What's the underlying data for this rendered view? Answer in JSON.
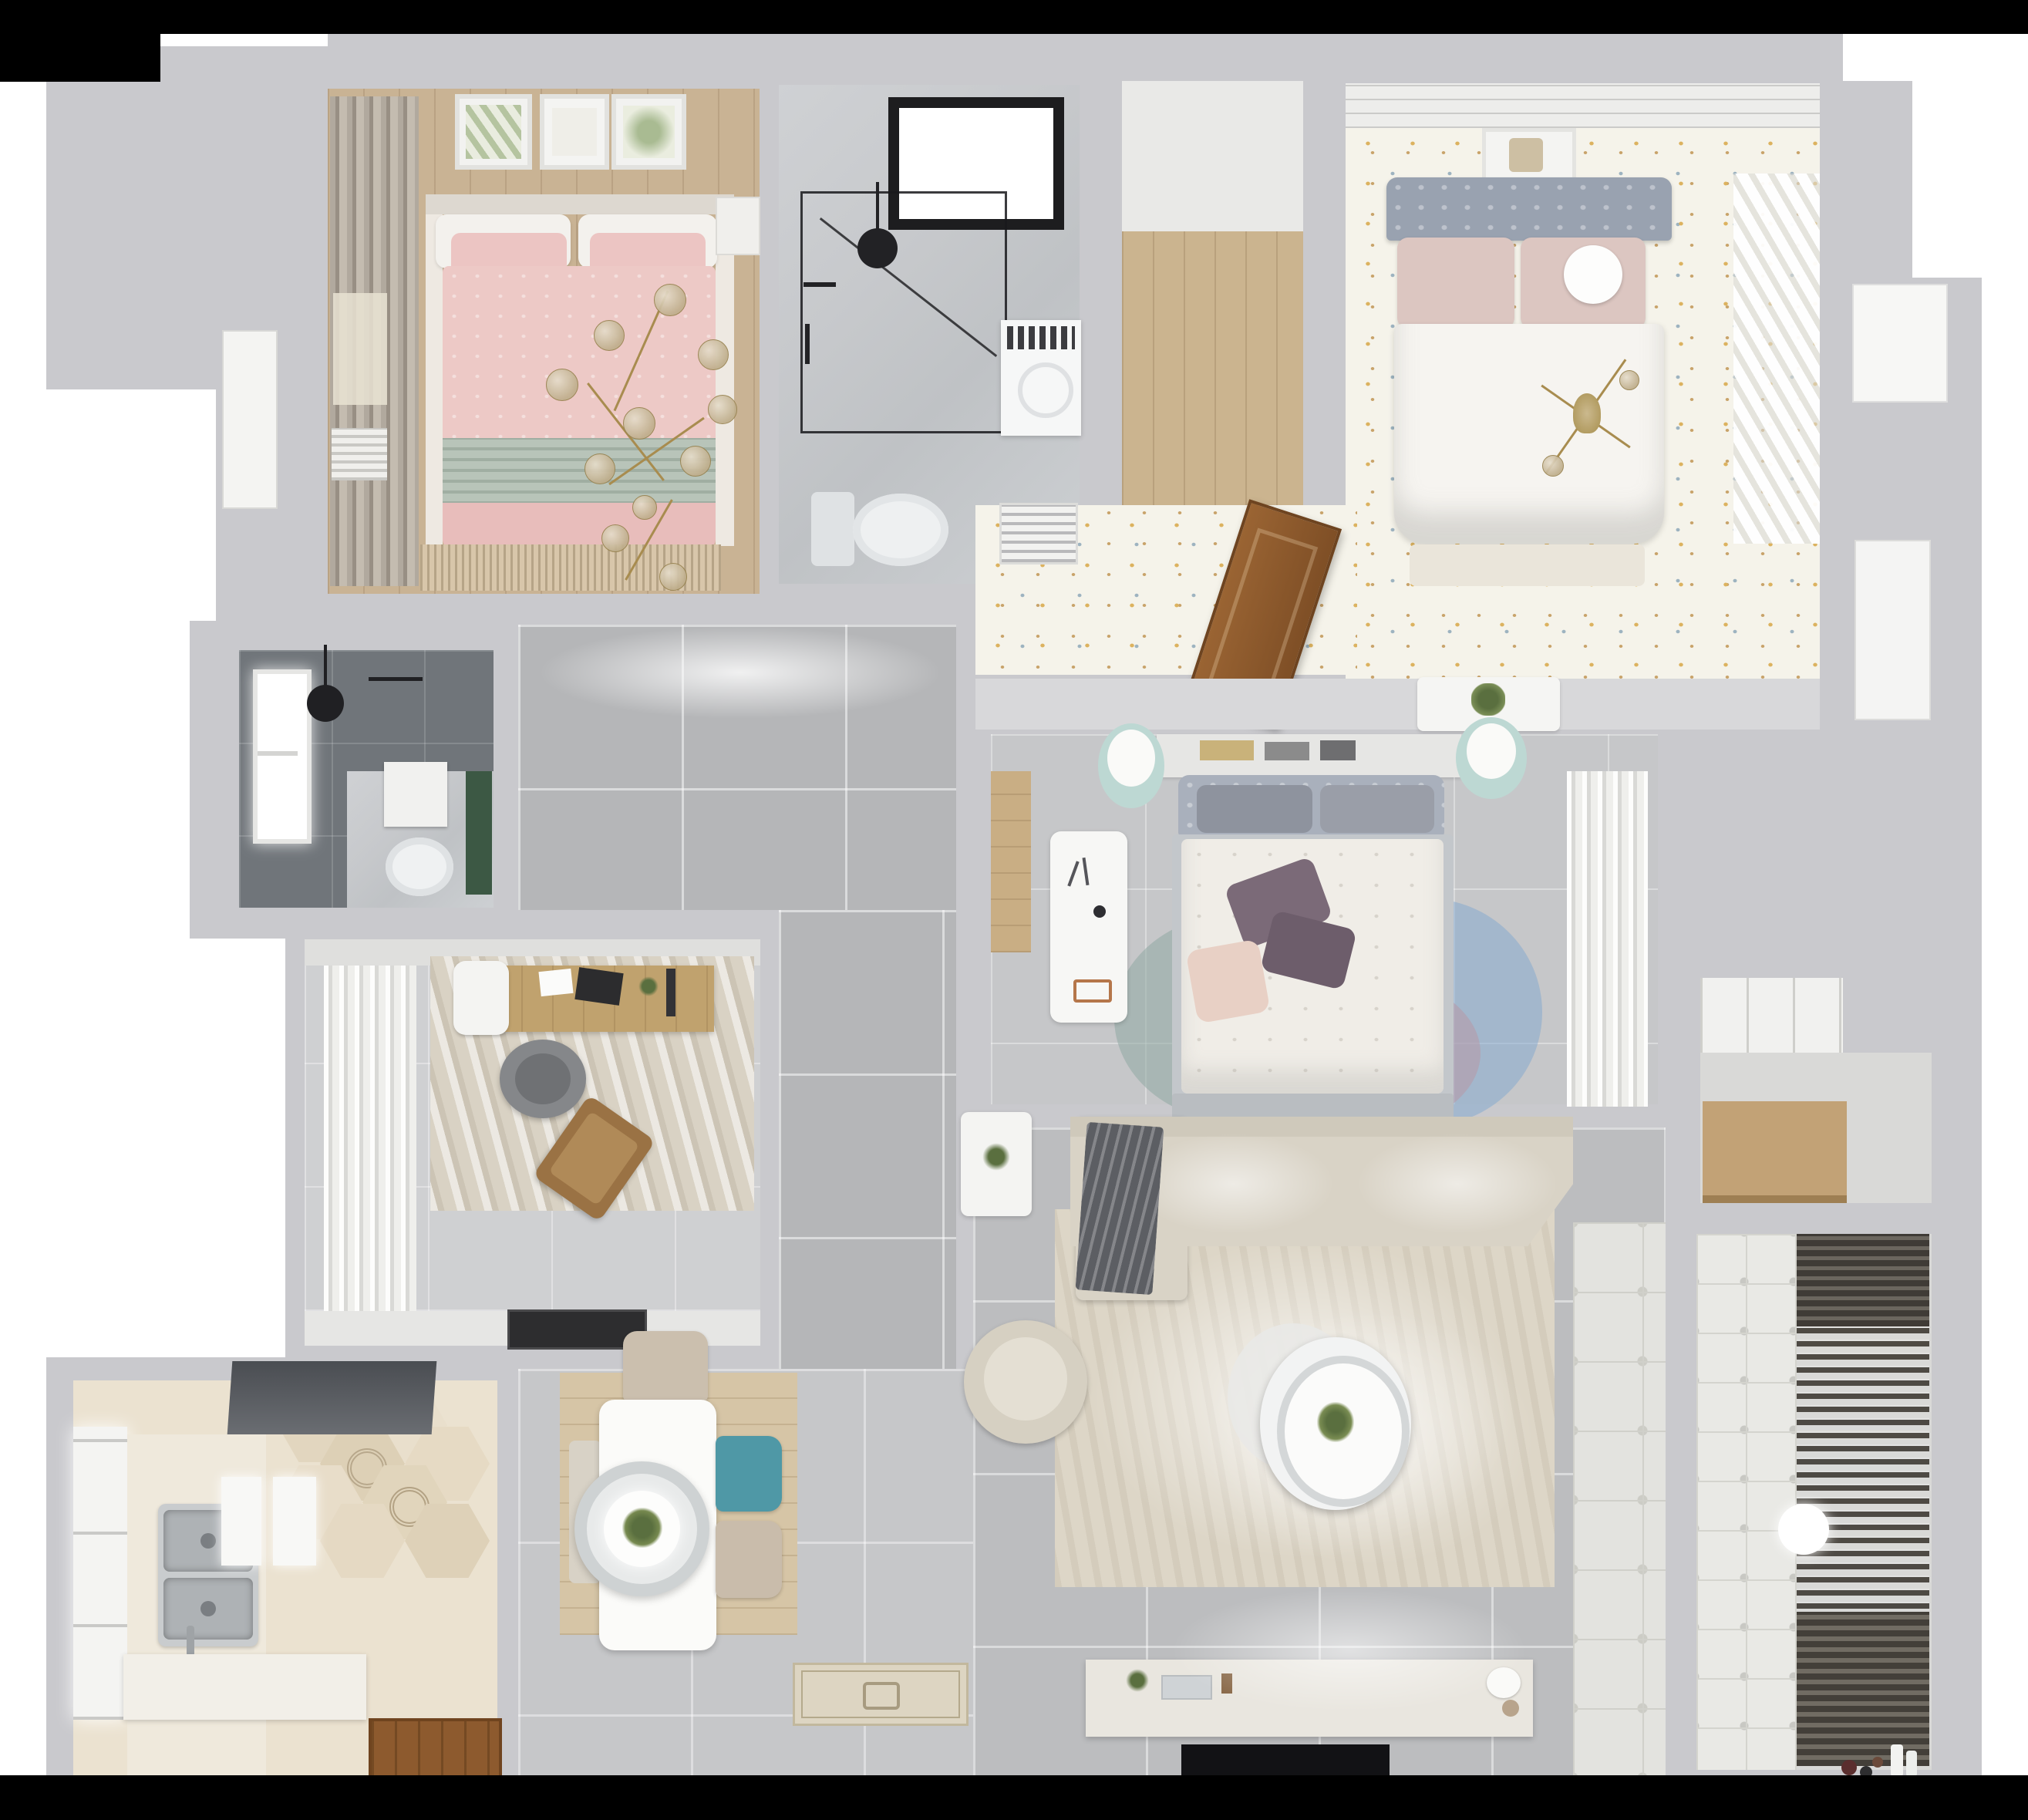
{
  "scene": {
    "title": "Top-down 3D render of an apartment floor plan",
    "type": "architectural-interior-render",
    "visible_text": []
  },
  "palette": {
    "background": "#ffffff",
    "letterbox": "#000000",
    "wall": "#c9c9cd",
    "wall_light": "#d8d8da",
    "floor_hall": "#b5b6b8",
    "floor_living": "#bcbdbf",
    "floor_dining": "#c6c7c9",
    "floor_study": "#cfd0d2",
    "floor_bedroom2": "#c6c7c9",
    "wood_floor": "#c9b394",
    "wood_closet": "#cbb48f",
    "wood_desk": "#c0a26e",
    "wood_shelf": "#c2a276",
    "wood_door": "#8d5a2e",
    "wood_rug": "#d6c5a6",
    "marble": "#c7c9cc",
    "dark_tile": "#70757a",
    "pink_duvet": "#edc9c6",
    "pink_pillow": "#ecc5c3",
    "sage": "#b8c4b9",
    "white_bedding": "#f3f1ed",
    "headboard_blue": "#99a2b0",
    "blush_pillow": "#dcc6c1",
    "floral_floor": "#f5f3ea",
    "dot_yellow": "#dcb25f",
    "dot_blue": "#9db3c0",
    "mint": "#bdd8d3",
    "purple_pillow": "#7b6a78",
    "rug_teal": "#8fa8a2",
    "rug_blue": "#7fa7d0",
    "rug_mauve": "#b995a2",
    "rug_beige": "#ddd6c7",
    "sofa_beige": "#d9d3c6",
    "blanket_gray": "#5c5e63",
    "teal_chair": "#4f98a6",
    "chair_beige": "#c9bcab",
    "hex_base": "#ebe2d0",
    "steel": "#aeb2b5",
    "black_fixture": "#1d1d1f",
    "tv_black": "#121215",
    "gold": "#a88c4f",
    "plant_green": "#5a6f3f",
    "rack_dark": "#4e4a44",
    "balcony_tile": "#e9e9e5",
    "curtain_taupe": "#b1a99e"
  },
  "rooms": [
    {
      "id": "bedroom-pink",
      "name": "Bedroom with pink bedding",
      "furniture": [
        "double bed",
        "white and pink pillows",
        "sage throw",
        "three botanical art frames",
        "taupe curtains",
        "window",
        "gold branch chandelier",
        "fringed rug",
        "slatted bench",
        "nightstand"
      ]
    },
    {
      "id": "bathroom-main",
      "name": "Main bathroom",
      "furniture": [
        "black framed skylight window",
        "glass shower enclosure",
        "black shower head",
        "washing machine",
        "toilet"
      ]
    },
    {
      "id": "walk-in-closet",
      "name": "Walk-in closet",
      "furniture": [
        "light wood floor"
      ]
    },
    {
      "id": "bedroom-master",
      "name": "Master bedroom",
      "furniture": [
        "tufted gray headboard",
        "blush pillows",
        "round white pillow",
        "white duvet",
        "wall art",
        "gold ceiling lamp",
        "bench",
        "sheer diagonal curtains",
        "floral dotted floor"
      ]
    },
    {
      "id": "vestibule",
      "name": "Bedroom vestibule",
      "furniture": [
        "AC vent grille",
        "open wooden door",
        "white console with plant"
      ]
    },
    {
      "id": "bedroom-second",
      "name": "Second bedroom",
      "furniture": [
        "bookshelf headboard wall",
        "gray headboard pillows",
        "white floral duvet",
        "purple pillows",
        "two mint stools",
        "white desk and chair",
        "round layered rug",
        "white curtains",
        "wood floor strip"
      ]
    },
    {
      "id": "bathroom-small",
      "name": "Shower room",
      "furniture": [
        "dark wall tiles",
        "window",
        "black shower head",
        "wall frame",
        "toilet"
      ]
    },
    {
      "id": "study",
      "name": "Study",
      "furniture": [
        "white ruffled curtains",
        "distressed rug",
        "wood desk",
        "laptop",
        "white side chair",
        "gray office chair",
        "wood lounge chair",
        "black doormat",
        "top cabinet band"
      ]
    },
    {
      "id": "hallway",
      "name": "Hallway",
      "furniture": [
        "large gray floor tiles"
      ]
    },
    {
      "id": "kitchen",
      "name": "Kitchen",
      "furniture": [
        "dark range hood",
        "double stainless sink",
        "white counter panels",
        "bottom counter",
        "chrome faucet",
        "window",
        "hex patterned tile floor",
        "wooden door threshold"
      ]
    },
    {
      "id": "dining",
      "name": "Dining area",
      "furniture": [
        "white rectangular table",
        "concentric pendant lamp with plant",
        "beige chair",
        "teal chair",
        "second beige chair",
        "partial left chair",
        "wood plank rug",
        "ornate entry mat"
      ]
    },
    {
      "id": "living",
      "name": "Living room",
      "furniture": [
        "L-shaped beige sofa",
        "dark gray blanket",
        "white side table with plant",
        "round armchair",
        "large beige rug",
        "two-tier round coffee table with plant",
        "TV console with decor",
        "flat black TV",
        "ornament tile walkway"
      ]
    },
    {
      "id": "storage",
      "name": "Storage nook",
      "furniture": [
        "white wardrobe shelves",
        "wooden shelf bench"
      ]
    },
    {
      "id": "balcony",
      "name": "Balcony / laundry",
      "furniture": [
        "patterned tile wall strip",
        "dark drying rack slats",
        "round white ceiling light",
        "toys",
        "white bottles"
      ]
    },
    {
      "id": "exterior",
      "name": "Right exterior ledge",
      "furniture": [
        "white upper door",
        "white lower door"
      ]
    }
  ]
}
